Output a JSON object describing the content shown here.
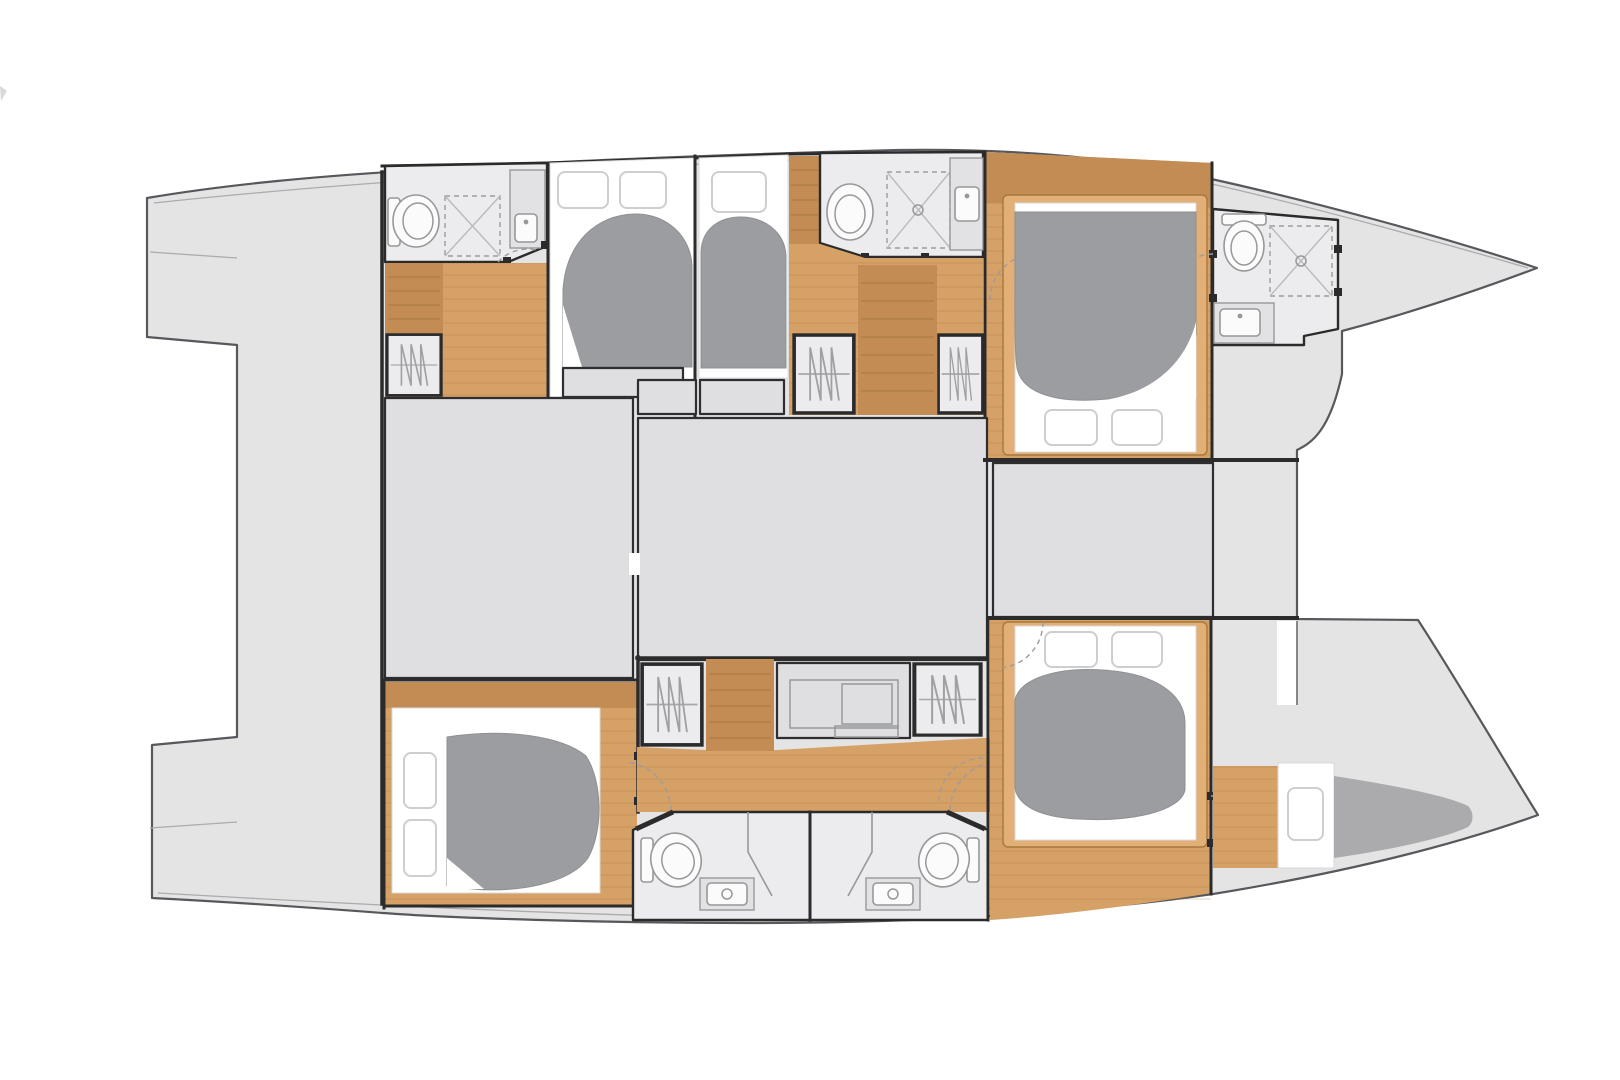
{
  "page": {
    "background": "#ffffff"
  },
  "diagram": {
    "kind": "yacht-floor-plan",
    "subject": "sailing catamaran interior deck plan, bow pointing right",
    "canvas": {
      "width": 1620,
      "height": 1080
    },
    "colors": {
      "background": "#ffffff",
      "deck": "#e4e4e5",
      "deck_outline": "#57585c",
      "wall": "#2b2b2c",
      "room_floor": "#ececee",
      "saloon_block": "#dfdfe1",
      "saloon_block_outline": "#2e2e30",
      "wood": "#d6a167",
      "wood_dark": "#c28c54",
      "wood_frame": "#e2b077",
      "wood_line": "#a5783f",
      "duvet": "#9c9da0",
      "mattress_wedge": "#ababad",
      "fixture_line": "#97989a",
      "thin_line": "#aaabad",
      "dash_line": "#9b9c9e"
    },
    "counts": {
      "double_cabins": 4,
      "single_berths": 2,
      "bathrooms": 5,
      "wardrobes": 5,
      "companionway_stairs": 3
    },
    "rooms": [
      {
        "id": "stern-platform",
        "name": "Transom swim platform and steps",
        "bbox": [
          147,
          198,
          90,
          700
        ],
        "fixtures": []
      },
      {
        "id": "cockpit-deck",
        "name": "Aft cockpit deck",
        "bbox": [
          237,
          170,
          146,
          740
        ],
        "fixtures": []
      },
      {
        "id": "saloon-block-port",
        "name": "Saloon settee / galley block port side",
        "bbox": [
          385,
          398,
          248,
          280
        ],
        "fixtures": []
      },
      {
        "id": "saloon-block-center",
        "name": "Saloon table / galley island",
        "bbox": [
          638,
          418,
          349,
          242
        ],
        "fixtures": []
      },
      {
        "id": "foredeck-block",
        "name": "Forward seat locker between hulls",
        "bbox": [
          993,
          463,
          220,
          154
        ],
        "fixtures": []
      },
      {
        "id": "port-aft-bathroom",
        "name": "Port aft bathroom",
        "bbox": [
          385,
          163,
          162,
          100
        ],
        "fixtures": [
          "toilet",
          "shower",
          "washbasin"
        ]
      },
      {
        "id": "port-aft-stairs",
        "name": "Port aft cabin steps",
        "bbox": [
          385,
          263,
          58,
          70
        ],
        "fixtures": []
      },
      {
        "id": "wardrobe-1",
        "name": "Wardrobe port aft cabin",
        "bbox": [
          385,
          333,
          58,
          64
        ],
        "fixtures": [
          "hanging locker"
        ]
      },
      {
        "id": "port-aft-cabin",
        "name": "Port aft double cabin",
        "bbox": [
          550,
          158,
          145,
          240
        ],
        "fixtures": [
          "double berth",
          "two pillows",
          "duvet"
        ]
      },
      {
        "id": "port-single-berth",
        "name": "Port midship single berth",
        "bbox": [
          697,
          155,
          91,
          243
        ],
        "fixtures": [
          "single berth",
          "pillow",
          "duvet"
        ]
      },
      {
        "id": "port-mid-bathroom",
        "name": "Port midship bathroom",
        "bbox": [
          817,
          152,
          166,
          106
        ],
        "fixtures": [
          "toilet",
          "shower",
          "washbasin"
        ]
      },
      {
        "id": "port-companionway",
        "name": "Port hull companionway stairs",
        "bbox": [
          858,
          265,
          79,
          150
        ],
        "fixtures": []
      },
      {
        "id": "wardrobe-2",
        "name": "Wardrobe port midship",
        "bbox": [
          792,
          333,
          64,
          82
        ],
        "fixtures": [
          "hanging locker"
        ]
      },
      {
        "id": "wardrobe-3",
        "name": "Wardrobe port forward",
        "bbox": [
          937,
          333,
          47,
          82
        ],
        "fixtures": [
          "hanging locker"
        ]
      },
      {
        "id": "port-forward-cabin",
        "name": "Port forward double cabin",
        "bbox": [
          985,
          152,
          228,
          306
        ],
        "fixtures": [
          "island double bed",
          "two pillows",
          "duvet"
        ]
      },
      {
        "id": "port-forward-bathroom",
        "name": "Port forward bathroom",
        "bbox": [
          1213,
          209,
          127,
          136
        ],
        "fixtures": [
          "toilet",
          "shower",
          "washbasin"
        ]
      },
      {
        "id": "port-bow-deck",
        "name": "Port bow deck",
        "bbox": [
          1342,
          180,
          195,
          130
        ],
        "fixtures": []
      },
      {
        "id": "trampoline",
        "name": "Trampoline area between bows",
        "bbox": [
          1297,
          268,
          241,
          547
        ],
        "fixtures": []
      },
      {
        "id": "foredeck-walkway",
        "name": "Foredeck walkway between hulls",
        "bbox": [
          1213,
          449,
          84,
          170
        ],
        "fixtures": []
      },
      {
        "id": "starboard-aft-cabin",
        "name": "Starboard aft double cabin",
        "bbox": [
          385,
          682,
          252,
          225
        ],
        "fixtures": [
          "double berth",
          "two pillows",
          "duvet"
        ]
      },
      {
        "id": "wardrobe-4",
        "name": "Wardrobe starboard aft",
        "bbox": [
          640,
          662,
          64,
          85
        ],
        "fixtures": [
          "hanging locker"
        ]
      },
      {
        "id": "starboard-companionway",
        "name": "Starboard hull companionway stairs",
        "bbox": [
          706,
          657,
          68,
          95
        ],
        "fixtures": []
      },
      {
        "id": "vanity-desk",
        "name": "Vanity desk starboard hull",
        "bbox": [
          777,
          663,
          133,
          75
        ],
        "fixtures": [
          "desk"
        ]
      },
      {
        "id": "wardrobe-5",
        "name": "Wardrobe starboard forward",
        "bbox": [
          912,
          662,
          71,
          75
        ],
        "fixtures": [
          "hanging locker"
        ]
      },
      {
        "id": "starboard-bathroom-left",
        "name": "Starboard aft bathroom",
        "bbox": [
          633,
          812,
          178,
          109
        ],
        "fixtures": [
          "toilet",
          "washbasin",
          "shower"
        ]
      },
      {
        "id": "starboard-bathroom-right",
        "name": "Starboard midship bathroom",
        "bbox": [
          811,
          812,
          177,
          109
        ],
        "fixtures": [
          "toilet",
          "washbasin",
          "shower"
        ]
      },
      {
        "id": "starboard-forward-cabin",
        "name": "Starboard forward double cabin",
        "bbox": [
          990,
          620,
          223,
          300
        ],
        "fixtures": [
          "island double bed",
          "two pillows",
          "duvet"
        ]
      },
      {
        "id": "forepeak-berth",
        "name": "Forepeak crew berth starboard bow",
        "bbox": [
          1213,
          763,
          267,
          105
        ],
        "fixtures": [
          "berth",
          "pillow"
        ]
      },
      {
        "id": "starboard-bow-deck",
        "name": "Starboard bow deck",
        "bbox": [
          1297,
          620,
          241,
          230
        ],
        "fixtures": []
      }
    ]
  }
}
